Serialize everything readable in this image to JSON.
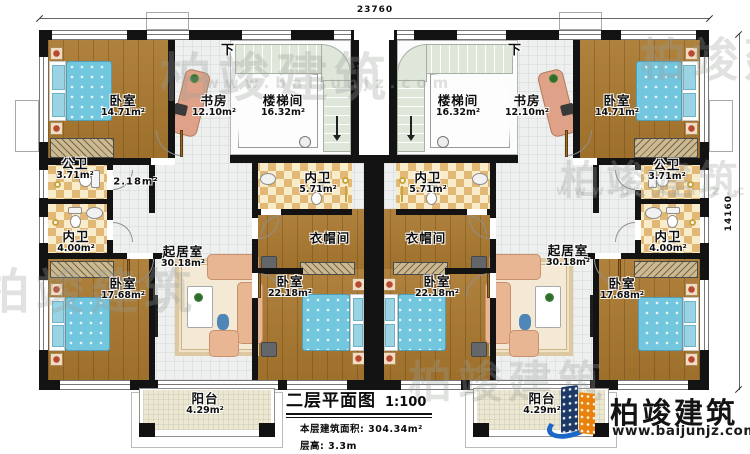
{
  "plan": {
    "dim_top": "23760",
    "dim_right": "14160"
  },
  "rooms": [
    {
      "name": "卧室",
      "area": "14.71m²",
      "x": 123,
      "y": 106
    },
    {
      "name": "书房",
      "area": "12.10m²",
      "x": 214,
      "y": 106
    },
    {
      "name": "楼梯间",
      "area": "16.32m²",
      "x": 283,
      "y": 106
    },
    {
      "name": "下",
      "x": 228,
      "y": 51,
      "cls": "dir"
    },
    {
      "name": "公卫",
      "area": "3.71m²",
      "x": 75,
      "y": 169
    },
    {
      "name": "2.18m²",
      "x": 136,
      "y": 183,
      "cls": "small"
    },
    {
      "name": "内卫",
      "area": "4.00m²",
      "x": 76,
      "y": 242
    },
    {
      "name": "内卫",
      "area": "5.71m²",
      "x": 318,
      "y": 183
    },
    {
      "name": "衣帽间",
      "x": 330,
      "y": 238
    },
    {
      "name": "卧室",
      "area": "17.68m²",
      "x": 123,
      "y": 289
    },
    {
      "name": "起居室",
      "area": "30.18m²",
      "x": 183,
      "y": 257
    },
    {
      "name": "卧室",
      "area": "22.18m²",
      "x": 290,
      "y": 287
    },
    {
      "name": "阳台",
      "area": "4.29m²",
      "x": 205,
      "y": 404
    },
    {
      "name": "楼梯间",
      "area": "16.32m²",
      "x": 458,
      "y": 106
    },
    {
      "name": "书房",
      "area": "12.10m²",
      "x": 527,
      "y": 106
    },
    {
      "name": "卧室",
      "area": "14.71m²",
      "x": 617,
      "y": 106
    },
    {
      "name": "下",
      "x": 515,
      "y": 51,
      "cls": "dir"
    },
    {
      "name": "内卫",
      "area": "5.71m²",
      "x": 428,
      "y": 183
    },
    {
      "name": "公卫",
      "area": "3.71m²",
      "x": 667,
      "y": 170
    },
    {
      "name": "内卫",
      "area": "4.00m²",
      "x": 668,
      "y": 242
    },
    {
      "name": "衣帽间",
      "x": 426,
      "y": 238
    },
    {
      "name": "卧室",
      "area": "22.18m²",
      "x": 437,
      "y": 287
    },
    {
      "name": "起居室",
      "area": "30.18m²",
      "x": 568,
      "y": 256
    },
    {
      "name": "卧室",
      "area": "17.68m²",
      "x": 622,
      "y": 289
    },
    {
      "name": "阳台",
      "area": "4.29m²",
      "x": 542,
      "y": 404
    }
  ],
  "title_block": {
    "title": "二层平面图",
    "scale": "1:100",
    "line1_label": "本层建筑面积:",
    "line1_value": "304.34m²",
    "line2_label": "层高:",
    "line2_value": "3.3m"
  },
  "logo": {
    "text": "柏竣建筑",
    "url": "www.baijunjz.com"
  },
  "watermarks": [
    {
      "text": "柏竣建筑",
      "x": 160,
      "y": 36,
      "size": 52
    },
    {
      "text": "www.baijunjz.com",
      "x": 205,
      "y": 74,
      "size": 15
    },
    {
      "text": "柏竣建筑",
      "x": 640,
      "y": 24,
      "size": 46
    },
    {
      "text": "柏竣建筑",
      "x": -18,
      "y": 252,
      "size": 48
    },
    {
      "text": "柏竣建筑",
      "x": 408,
      "y": 346,
      "size": 44
    },
    {
      "text": "柏竣建筑",
      "x": 560,
      "y": 148,
      "size": 40
    },
    {
      "text": "www.baijunjz.com",
      "x": 556,
      "y": 184,
      "size": 13
    }
  ],
  "colors": {
    "wall": "#131313",
    "wood_floor": "#a9782f",
    "tile_floor": "#eef0ef",
    "bath_tile": "#e2b877",
    "stair": "#dfe6da",
    "mattress": "#72c6de",
    "sofa": "#e9b694",
    "logo_blue": "#1c68c8",
    "logo_navy": "#1d3a66",
    "logo_orange": "#e8820c"
  }
}
